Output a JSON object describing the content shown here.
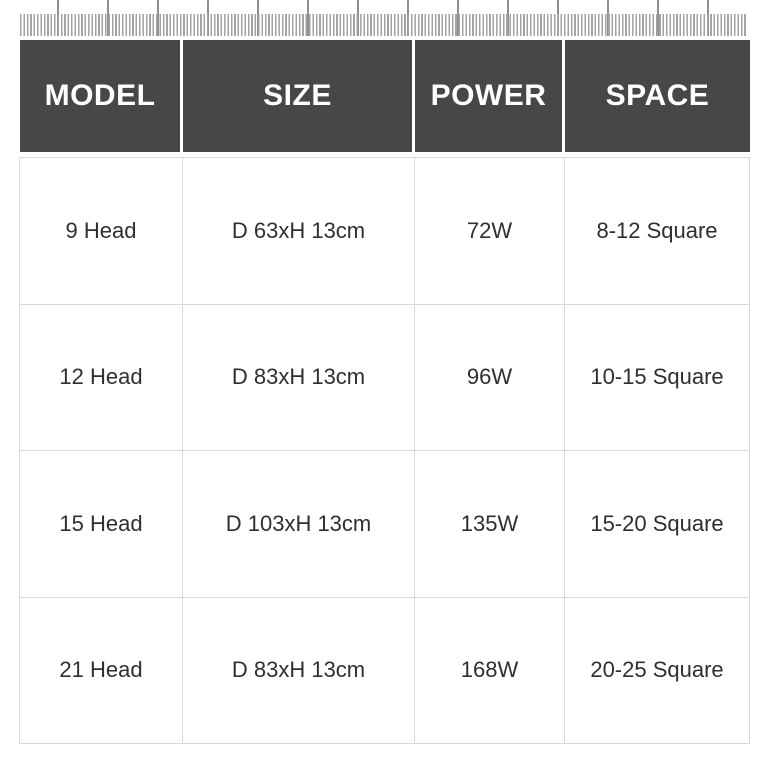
{
  "table": {
    "headers": [
      "MODEL",
      "SIZE",
      "POWER",
      "SPACE"
    ],
    "rows": [
      [
        "9 Head",
        "D 63xH 13cm",
        "72W",
        "8-12 Square"
      ],
      [
        "12 Head",
        "D 83xH 13cm",
        "96W",
        "10-15 Square"
      ],
      [
        "15 Head",
        "D 103xH 13cm",
        "135W",
        "15-20 Square"
      ],
      [
        "21 Head",
        "D 83xH 13cm",
        "168W",
        "20-25 Square"
      ]
    ]
  },
  "colors": {
    "header_bg": "#474747",
    "header_text": "#ffffff",
    "body_text": "#2f2f2f",
    "cell_border": "#d9d9d9",
    "ruler_tick": "#a3a3a3",
    "ruler_tick_tall": "#8f8f8f",
    "background": "#ffffff"
  }
}
